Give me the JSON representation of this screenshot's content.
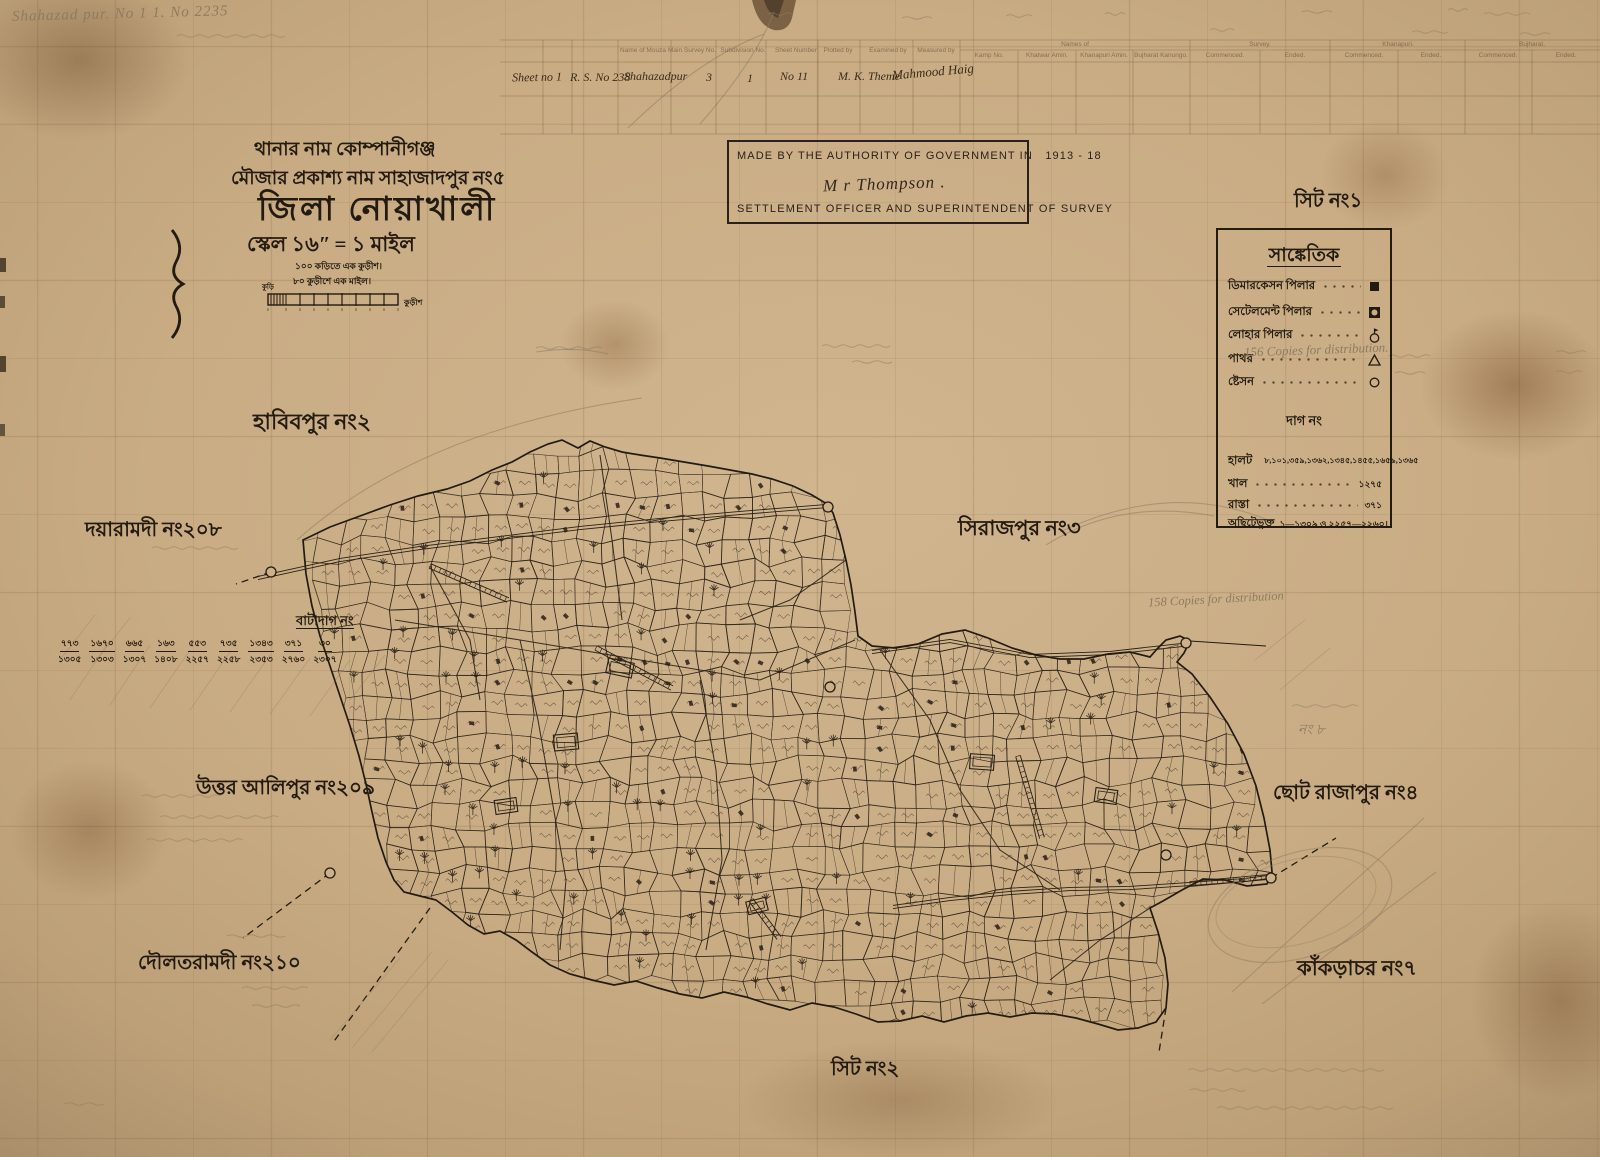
{
  "colors": {
    "paper": "#c9ac84",
    "ink": "#241b10",
    "pencil": "#8d7b60",
    "stamp_ink": "#2a211a"
  },
  "corner_note": "Shahazad pur.  No 1 1. No 2235",
  "form": {
    "entries": {
      "sheet_no": "Sheet no 1",
      "rs_no": "R. S. No 238",
      "mouza": "Shahazadpur",
      "main_survey_no": "3",
      "subdivision_no": "1",
      "sheet_number": "No 11",
      "plotted_by": "M. K. Theme",
      "examined_by": "Mahmood Haig"
    },
    "left_headers": [
      "Name of Mouza",
      "Main Survey No.",
      "Subdivision No.",
      "Sheet Number",
      "Plotted by",
      "Examined by",
      "Measured by"
    ],
    "groups": [
      {
        "label": "Names of",
        "subs": [
          "Kamp No.",
          "Khatwar Amin.",
          "Khanapuri Amin.",
          "Bujharat Kanungo."
        ]
      },
      {
        "label": "Survey.",
        "subs": [
          "Commenced.",
          "Ended."
        ]
      },
      {
        "label": "Khanapuri.",
        "subs": [
          "Commenced.",
          "Ended."
        ]
      },
      {
        "label": "Bujharat.",
        "subs": [
          "Commenced.",
          "Ended."
        ]
      }
    ]
  },
  "title_block": {
    "line1": "থানার নাম কোম্পানীগঞ্জ",
    "line2": "মৌজার প্রকাশ্য নাম সাহাজাদপুর নং৫",
    "line3": "জিলা নোয়াখালী",
    "line4": "স্কেল ১৬ʺ = ১ মাইল",
    "scale_note1": "১০০ কড়িতে এক কুড়ীশ।",
    "scale_note2": "৮০ কুড়ীশে এক মাইল।",
    "scale_left": "কুড়ি",
    "scale_right": "কুড়ীশ"
  },
  "stamp": {
    "line1": "MADE BY THE AUTHORITY OF GOVERNMENT IN",
    "years": "1913 - 18",
    "signature": "M r Thompson .",
    "line2": "SETTLEMENT OFFICER AND SUPERINTENDENT OF SURVEY"
  },
  "sheet_label_1": "সিট নং১",
  "sheet_label_2": "সিট নং২",
  "legend": {
    "title": "সাঙ্কেতিক",
    "items": [
      {
        "label": "ডিমারকেসন পিলার",
        "symbol": "filled-square"
      },
      {
        "label": "সেটেলমেন্ট পিলার",
        "symbol": "square-with-circle"
      },
      {
        "label": "লোহার পিলার",
        "symbol": "circle-with-flag"
      },
      {
        "label": "পাথর",
        "symbol": "triangle"
      },
      {
        "label": "ষ্টেসন",
        "symbol": "circle"
      }
    ],
    "dag_header": "দাগ নং",
    "dag_rows": [
      {
        "label": "হালট",
        "value": "৮,১০১,৩৫৯,১৩৬২,১৩৪৫,১৪৫৫,১৬৫৯,১৩৬৫"
      },
      {
        "label": "খাল",
        "value": "১২৭৫"
      },
      {
        "label": "রাস্তা",
        "value": "৩৭১"
      },
      {
        "label": "অছিটেভুক্ত",
        "value": "১—১৩০৯ ও ২২৫৭—২২৬০।"
      }
    ]
  },
  "neighbors": [
    {
      "name": "হাবিবপুর নং২"
    },
    {
      "name": "দয়ারামদী নং২০৮"
    },
    {
      "name": "সিরাজপুর নং৩"
    },
    {
      "name": "উত্তর আলিপুর নং২০৯"
    },
    {
      "name": "ছোট রাজাপুর নং৪"
    },
    {
      "name": "দৌলতরামদী নং২১০"
    },
    {
      "name": "কাঁকড়াচর নং৭"
    }
  ],
  "batadag": {
    "title": "বাটাদাগ নং",
    "pairs": [
      {
        "top": "৭৭৩",
        "bottom": "১৩০৫"
      },
      {
        "top": "১৬৭০",
        "bottom": "১৩০৩"
      },
      {
        "top": "৬৬৫",
        "bottom": "১৩০৭"
      },
      {
        "top": "১৬৩",
        "bottom": "১৪০৮"
      },
      {
        "top": "৫৫৩",
        "bottom": "২২৫৭"
      },
      {
        "top": "৭৩৫",
        "bottom": "২২৫৮"
      },
      {
        "top": "১৩৪৩",
        "bottom": "২৩৫৩"
      },
      {
        "top": "৩৭১",
        "bottom": "২৭৬০"
      },
      {
        "top": "৩০",
        "bottom": "২৩০৭"
      }
    ]
  },
  "pencil_notes": {
    "legend_copies": "156 Copies for distribution.",
    "map_copies": "158 Copies for distribution",
    "no8": "নং ৮"
  }
}
